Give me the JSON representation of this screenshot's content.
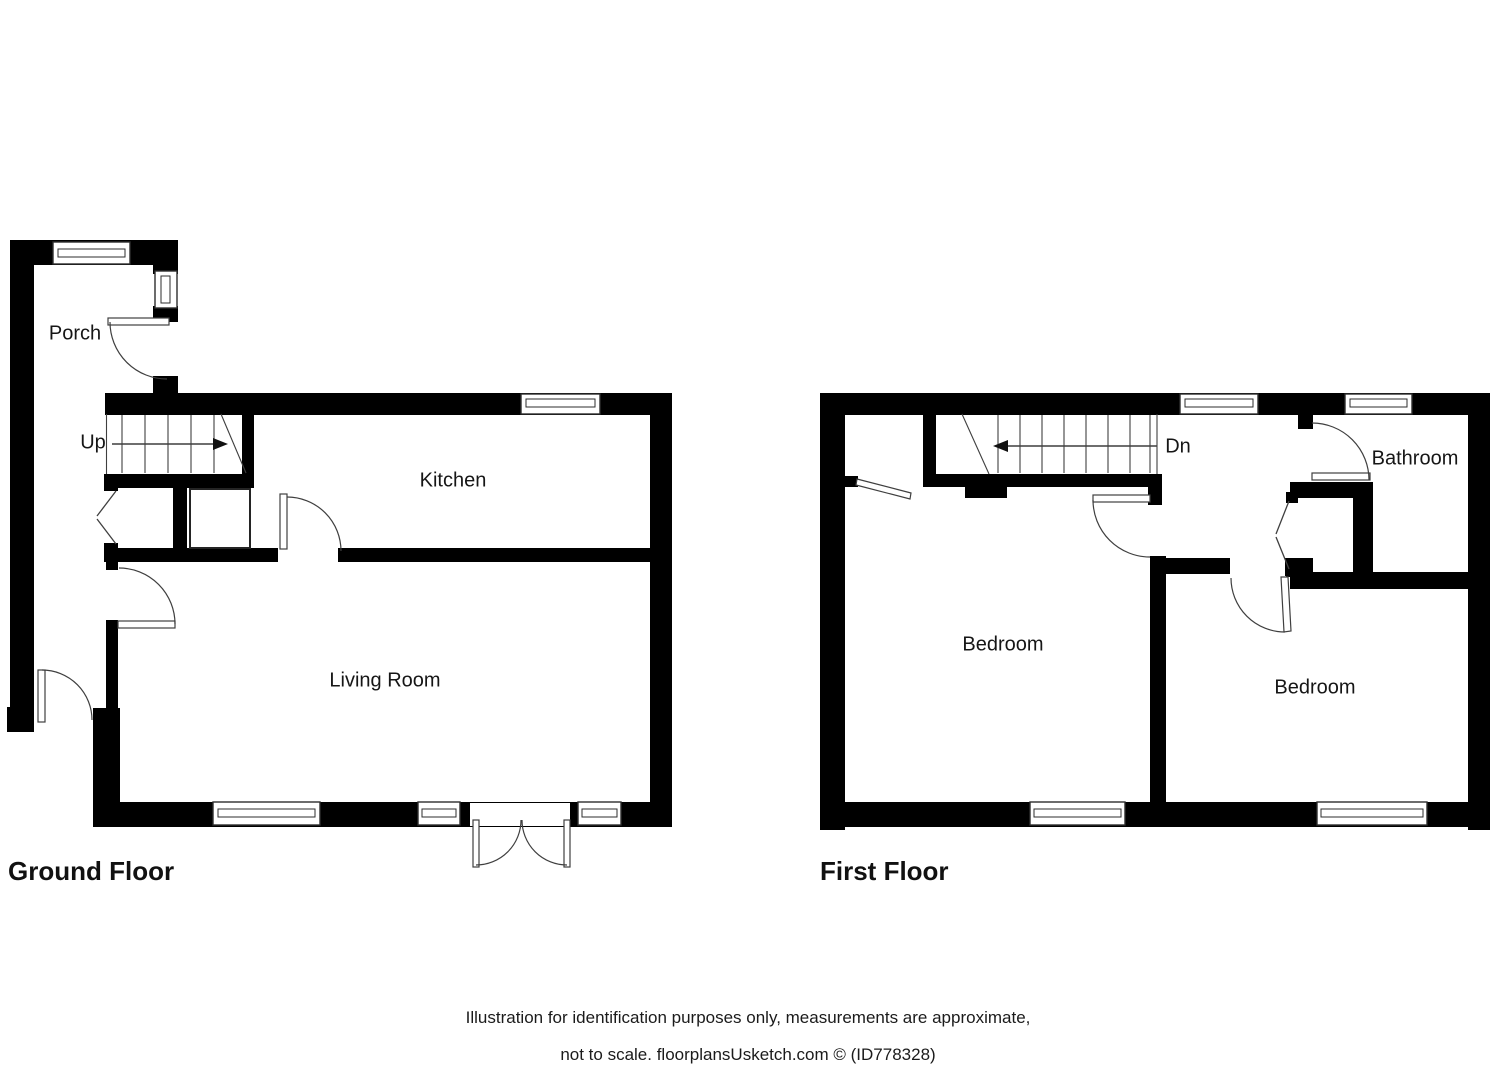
{
  "palette": {
    "background": "#ffffff",
    "wall": "#000000",
    "thin_line": "#3f3f3f",
    "text": "#161616"
  },
  "ground_floor": {
    "title": "Ground Floor",
    "rooms": {
      "porch": "Porch",
      "kitchen": "Kitchen",
      "living_room": "Living Room"
    },
    "stairs": {
      "label": "Up",
      "direction": "arrow-points-right"
    }
  },
  "first_floor": {
    "title": "First Floor",
    "rooms": {
      "bathroom": "Bathroom",
      "bedroom_left": "Bedroom",
      "bedroom_right": "Bedroom"
    },
    "stairs": {
      "label": "Dn",
      "direction": "arrow-points-left"
    }
  },
  "footer": {
    "line1": "Illustration for identification purposes only, measurements are approximate,",
    "line2": "not to scale. floorplansUsketch.com © (ID778328)"
  }
}
